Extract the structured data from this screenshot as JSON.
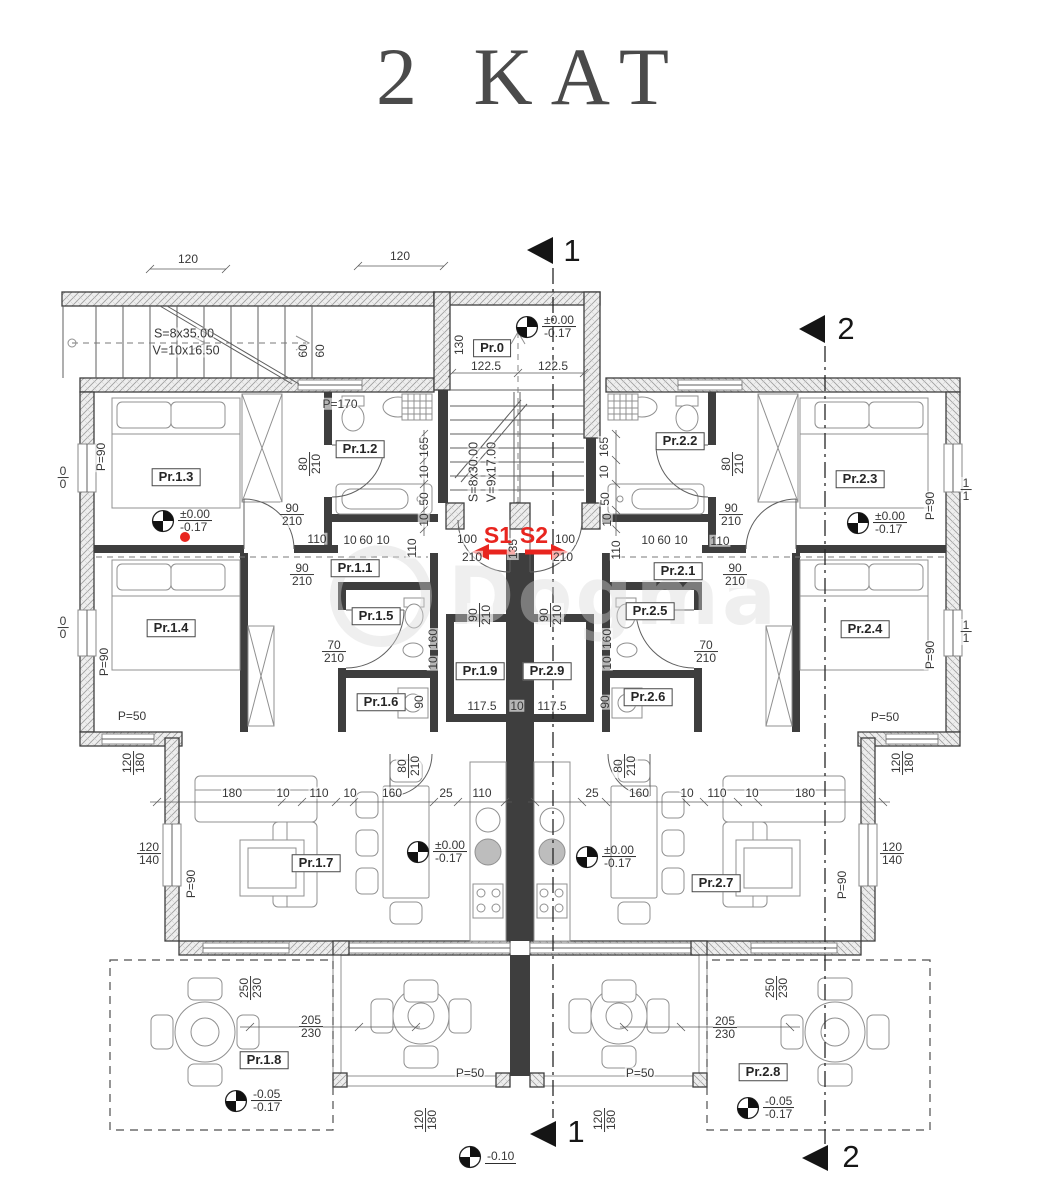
{
  "title": "2 KAT",
  "watermark": {
    "text": "Dogma"
  },
  "colors": {
    "ink": "#383838",
    "wall": "#3e3e3e",
    "accent_red": "#e8251f",
    "paper": "#ffffff"
  },
  "plan": {
    "room_labels": [
      {
        "t": "Pr.0",
        "x": 492,
        "y": 348
      },
      {
        "t": "Pr.1.3",
        "x": 176,
        "y": 477
      },
      {
        "t": "Pr.1.2",
        "x": 360,
        "y": 449
      },
      {
        "t": "Pr.1.1",
        "x": 355,
        "y": 568
      },
      {
        "t": "Pr.1.4",
        "x": 171,
        "y": 628
      },
      {
        "t": "Pr.1.5",
        "x": 376,
        "y": 616
      },
      {
        "t": "Pr.1.6",
        "x": 381,
        "y": 702
      },
      {
        "t": "Pr.1.9",
        "x": 480,
        "y": 671
      },
      {
        "t": "Pr.2.9",
        "x": 547,
        "y": 671
      },
      {
        "t": "Pr.1.7",
        "x": 316,
        "y": 863
      },
      {
        "t": "Pr.1.8",
        "x": 264,
        "y": 1060
      },
      {
        "t": "Pr.2.2",
        "x": 680,
        "y": 441
      },
      {
        "t": "Pr.2.3",
        "x": 860,
        "y": 479
      },
      {
        "t": "Pr.2.1",
        "x": 678,
        "y": 571
      },
      {
        "t": "Pr.2.5",
        "x": 650,
        "y": 611
      },
      {
        "t": "Pr.2.6",
        "x": 648,
        "y": 697
      },
      {
        "t": "Pr.2.4",
        "x": 865,
        "y": 629
      },
      {
        "t": "Pr.2.7",
        "x": 716,
        "y": 883
      },
      {
        "t": "Pr.2.8",
        "x": 763,
        "y": 1072
      }
    ],
    "section_labels": [
      {
        "t": "1",
        "x": 572,
        "y": 251
      },
      {
        "t": "2",
        "x": 846,
        "y": 329
      },
      {
        "t": "1",
        "x": 576,
        "y": 1132
      },
      {
        "t": "2",
        "x": 851,
        "y": 1157
      }
    ],
    "stair_specs": [
      {
        "t": "S=8x35.00",
        "x": 184,
        "y": 334
      },
      {
        "t": "V=10x16.50",
        "x": 186,
        "y": 351
      },
      {
        "t": "S=8x30.00",
        "x": 474,
        "y": 472,
        "r": 1
      },
      {
        "t": "V=9x17.00",
        "x": 492,
        "y": 472,
        "r": 1
      }
    ],
    "red_labels": [
      {
        "t": "S1",
        "x": 498,
        "y": 536
      },
      {
        "t": "S2",
        "x": 534,
        "y": 536
      }
    ],
    "elevations": [
      {
        "x": 527,
        "y": 327,
        "a": "±0.00",
        "b": "-0.17"
      },
      {
        "x": 163,
        "y": 521,
        "a": "±0.00",
        "b": "-0.17"
      },
      {
        "x": 858,
        "y": 523,
        "a": "±0.00",
        "b": "-0.17"
      },
      {
        "x": 418,
        "y": 852,
        "a": "±0.00",
        "b": "-0.17"
      },
      {
        "x": 587,
        "y": 857,
        "a": "±0.00",
        "b": "-0.17"
      },
      {
        "x": 236,
        "y": 1101,
        "a": "-0.05",
        "b": "-0.17"
      },
      {
        "x": 748,
        "y": 1108,
        "a": "-0.05",
        "b": "-0.17"
      },
      {
        "x": 470,
        "y": 1157,
        "a": "-0.10"
      }
    ],
    "p_labels": [
      {
        "t": "P=170",
        "x": 340,
        "y": 404
      },
      {
        "t": "P=90",
        "x": 101,
        "y": 457,
        "r": 1
      },
      {
        "t": "P=90",
        "x": 104,
        "y": 662,
        "r": 1
      },
      {
        "t": "P=90",
        "x": 191,
        "y": 884,
        "r": 1
      },
      {
        "t": "P=90",
        "x": 930,
        "y": 506,
        "r": 1
      },
      {
        "t": "P=90",
        "x": 930,
        "y": 655,
        "r": 1
      },
      {
        "t": "P=90",
        "x": 842,
        "y": 885,
        "r": 1
      },
      {
        "t": "P=50",
        "x": 132,
        "y": 716
      },
      {
        "t": "P=50",
        "x": 885,
        "y": 717
      },
      {
        "t": "P=50",
        "x": 470,
        "y": 1073
      },
      {
        "t": "P=50",
        "x": 640,
        "y": 1073
      }
    ],
    "dims": [
      {
        "t": "120",
        "x": 188,
        "y": 259
      },
      {
        "t": "120",
        "x": 400,
        "y": 256
      },
      {
        "t": "60",
        "x": 303,
        "y": 351,
        "r": 1
      },
      {
        "t": "60",
        "x": 320,
        "y": 351,
        "r": 1
      },
      {
        "t": "130",
        "x": 459,
        "y": 345,
        "r": 1
      },
      {
        "t": "122.5",
        "x": 486,
        "y": 366
      },
      {
        "t": "122.5",
        "x": 553,
        "y": 366
      },
      {
        "t": "100",
        "x": 467,
        "y": 539
      },
      {
        "t": "100",
        "x": 565,
        "y": 539
      },
      {
        "t": "210",
        "x": 472,
        "y": 557
      },
      {
        "t": "210",
        "x": 563,
        "y": 557
      },
      {
        "t": "135",
        "x": 513,
        "y": 549,
        "r": 1
      },
      {
        "t": "165",
        "x": 424,
        "y": 447,
        "r": 1
      },
      {
        "t": "10",
        "x": 424,
        "y": 472,
        "r": 1
      },
      {
        "t": "50",
        "x": 424,
        "y": 499,
        "r": 1
      },
      {
        "t": "10",
        "x": 424,
        "y": 520,
        "r": 1
      },
      {
        "t": "110",
        "x": 412,
        "y": 548,
        "r": 1
      },
      {
        "t": "165",
        "x": 604,
        "y": 447,
        "r": 1
      },
      {
        "t": "10",
        "x": 604,
        "y": 472,
        "r": 1
      },
      {
        "t": "50",
        "x": 605,
        "y": 499,
        "r": 1
      },
      {
        "t": "10",
        "x": 607,
        "y": 520,
        "r": 1
      },
      {
        "t": "110",
        "x": 616,
        "y": 550,
        "r": 1
      },
      {
        "t": "110",
        "x": 317,
        "y": 539
      },
      {
        "t": "10",
        "x": 350,
        "y": 540
      },
      {
        "t": "60",
        "x": 366,
        "y": 540
      },
      {
        "t": "10",
        "x": 383,
        "y": 540
      },
      {
        "t": "10",
        "x": 648,
        "y": 540
      },
      {
        "t": "60",
        "x": 664,
        "y": 540
      },
      {
        "t": "10",
        "x": 681,
        "y": 540
      },
      {
        "t": "110",
        "x": 720,
        "y": 541
      },
      {
        "t": "90",
        "x": 419,
        "y": 702,
        "r": 1
      },
      {
        "t": "90",
        "x": 605,
        "y": 702,
        "r": 1
      },
      {
        "t": "160",
        "x": 433,
        "y": 639,
        "r": 1
      },
      {
        "t": "10",
        "x": 433,
        "y": 663,
        "r": 1
      },
      {
        "t": "160",
        "x": 607,
        "y": 639,
        "r": 1
      },
      {
        "t": "10",
        "x": 607,
        "y": 663,
        "r": 1
      },
      {
        "t": "117.5",
        "x": 482,
        "y": 706
      },
      {
        "t": "10",
        "x": 517,
        "y": 706
      },
      {
        "t": "117.5",
        "x": 552,
        "y": 706
      },
      {
        "t": "180",
        "x": 232,
        "y": 793
      },
      {
        "t": "10",
        "x": 283,
        "y": 793
      },
      {
        "t": "110",
        "x": 319,
        "y": 793
      },
      {
        "t": "10",
        "x": 350,
        "y": 793
      },
      {
        "t": "160",
        "x": 392,
        "y": 793
      },
      {
        "t": "25",
        "x": 446,
        "y": 793
      },
      {
        "t": "110",
        "x": 482,
        "y": 793
      },
      {
        "t": "25",
        "x": 592,
        "y": 793
      },
      {
        "t": "160",
        "x": 639,
        "y": 793
      },
      {
        "t": "10",
        "x": 687,
        "y": 793
      },
      {
        "t": "110",
        "x": 717,
        "y": 793
      },
      {
        "t": "10",
        "x": 752,
        "y": 793
      },
      {
        "t": "180",
        "x": 805,
        "y": 793
      }
    ],
    "fracs": [
      {
        "a": "80",
        "b": "210",
        "x": 310,
        "y": 464,
        "r": 1
      },
      {
        "a": "80",
        "b": "210",
        "x": 733,
        "y": 464,
        "r": 1
      },
      {
        "a": "90",
        "b": "210",
        "x": 292,
        "y": 515
      },
      {
        "a": "90",
        "b": "210",
        "x": 731,
        "y": 515
      },
      {
        "a": "90",
        "b": "210",
        "x": 302,
        "y": 575
      },
      {
        "a": "90",
        "b": "210",
        "x": 735,
        "y": 575
      },
      {
        "a": "70",
        "b": "210",
        "x": 334,
        "y": 652
      },
      {
        "a": "70",
        "b": "210",
        "x": 706,
        "y": 652
      },
      {
        "a": "90",
        "b": "210",
        "x": 480,
        "y": 615,
        "r": 1
      },
      {
        "a": "90",
        "b": "210",
        "x": 551,
        "y": 615,
        "r": 1
      },
      {
        "a": "120",
        "b": "180",
        "x": 134,
        "y": 763,
        "r": 1
      },
      {
        "a": "120",
        "b": "180",
        "x": 903,
        "y": 763,
        "r": 1
      },
      {
        "a": "120",
        "b": "140",
        "x": 149,
        "y": 854
      },
      {
        "a": "120",
        "b": "140",
        "x": 892,
        "y": 854
      },
      {
        "a": "80",
        "b": "210",
        "x": 409,
        "y": 766,
        "r": 1
      },
      {
        "a": "80",
        "b": "210",
        "x": 625,
        "y": 766,
        "r": 1
      },
      {
        "a": "250",
        "b": "230",
        "x": 251,
        "y": 988,
        "r": 1
      },
      {
        "a": "250",
        "b": "230",
        "x": 777,
        "y": 988,
        "r": 1
      },
      {
        "a": "205",
        "b": "230",
        "x": 311,
        "y": 1027
      },
      {
        "a": "205",
        "b": "230",
        "x": 725,
        "y": 1028
      },
      {
        "a": "120",
        "b": "180",
        "x": 426,
        "y": 1120,
        "r": 1
      },
      {
        "a": "120",
        "b": "180",
        "x": 605,
        "y": 1120,
        "r": 1
      },
      {
        "a": "0",
        "b": "0",
        "x": 63,
        "y": 478
      },
      {
        "a": "0",
        "b": "0",
        "x": 63,
        "y": 628
      },
      {
        "a": "1",
        "b": "1",
        "x": 966,
        "y": 490
      },
      {
        "a": "1",
        "b": "1",
        "x": 966,
        "y": 632
      }
    ]
  }
}
